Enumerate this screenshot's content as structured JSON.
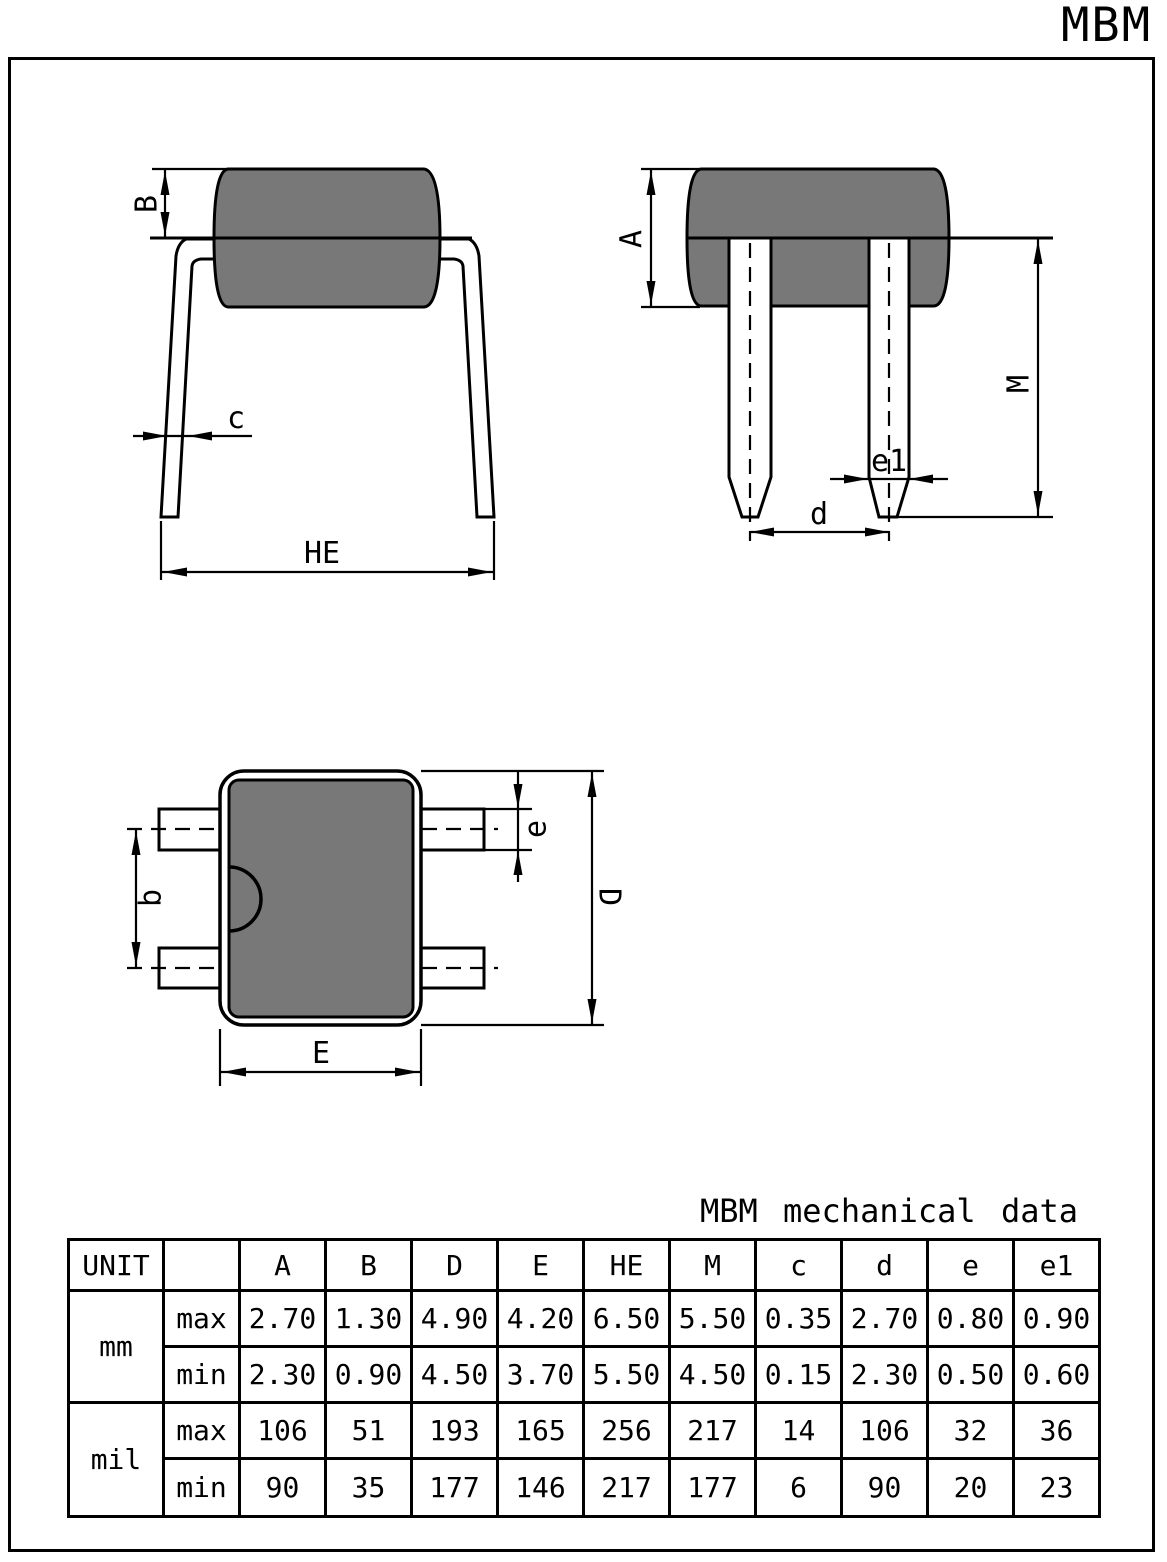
{
  "title": "MBM",
  "colors": {
    "body_gray": "#787878",
    "line": "#000000"
  },
  "views": {
    "front": {
      "labels": {
        "B": "B",
        "c": "c",
        "HE": "HE"
      }
    },
    "side": {
      "labels": {
        "A": "A",
        "M": "M",
        "e1": "e1",
        "d": "d"
      }
    },
    "top": {
      "labels": {
        "b": "b",
        "e": "e",
        "D": "D",
        "E": "E"
      }
    }
  },
  "table": {
    "caption": "MBM mechanical data",
    "unit_header": "UNIT",
    "columns": [
      "A",
      "B",
      "D",
      "E",
      "HE",
      "M",
      "c",
      "d",
      "e",
      "e1"
    ],
    "row_groups": [
      {
        "unit": "mm",
        "rows": [
          {
            "label": "max",
            "values": [
              "2.70",
              "1.30",
              "4.90",
              "4.20",
              "6.50",
              "5.50",
              "0.35",
              "2.70",
              "0.80",
              "0.90"
            ]
          },
          {
            "label": "min",
            "values": [
              "2.30",
              "0.90",
              "4.50",
              "3.70",
              "5.50",
              "4.50",
              "0.15",
              "2.30",
              "0.50",
              "0.60"
            ]
          }
        ]
      },
      {
        "unit": "mil",
        "rows": [
          {
            "label": "max",
            "values": [
              "106",
              "51",
              "193",
              "165",
              "256",
              "217",
              "14",
              "106",
              "32",
              "36"
            ]
          },
          {
            "label": "min",
            "values": [
              "90",
              "35",
              "177",
              "146",
              "217",
              "177",
              "6",
              "90",
              "20",
              "23"
            ]
          }
        ]
      }
    ]
  }
}
